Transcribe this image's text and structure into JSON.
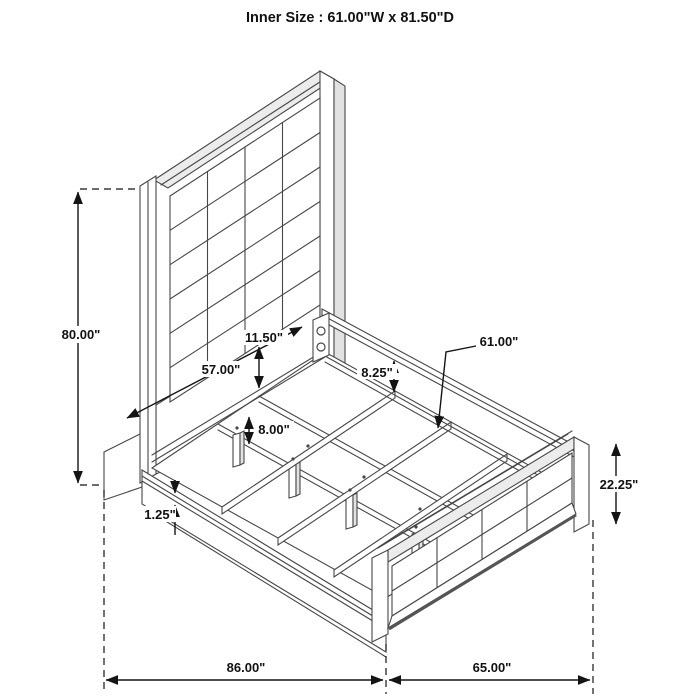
{
  "title": "Inner Size : 61.00\"W x 81.50\"D",
  "diagram": {
    "type": "bed-frame-assembly-dimension-diagram",
    "views": [
      "isometric bed with upholstered headboard and footboard"
    ],
    "labels": {
      "height": "80.00\"",
      "headboard_width": "57.00\"",
      "panel_gap": "11.50\"",
      "rail_drop": "8.25\"",
      "slat_length": "61.00\"",
      "leg_height": "8.00\"",
      "rail_lip": "1.25\"",
      "footboard_height": "22.25\"",
      "overall_depth": "86.00\"",
      "overall_width": "65.00\""
    }
  }
}
